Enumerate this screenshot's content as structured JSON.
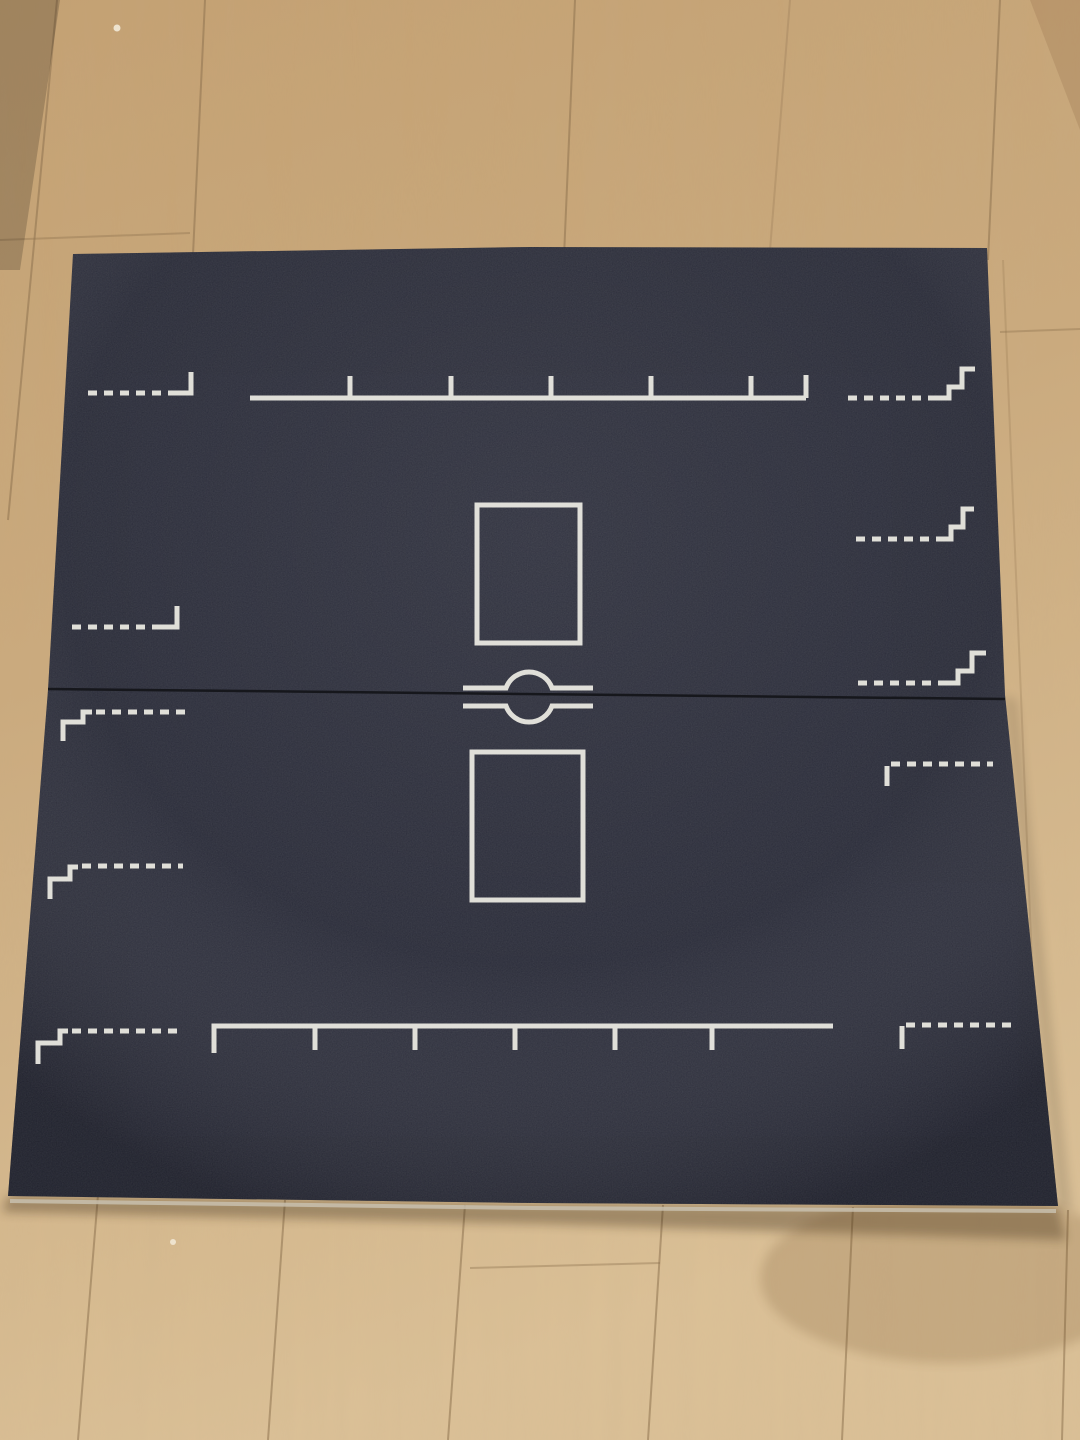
{
  "scene": {
    "description": "Top-down photograph of a black folding game pitch board lying on a light wooden plank floor",
    "board": {
      "surface_color": "#292b33",
      "marking_color": "#e7e6df",
      "fold_seam_color": "#16171c",
      "edge_highlight_color": "#c8bfae",
      "halves": 2,
      "markings": [
        {
          "name": "top-left-corner-mark",
          "type": "dashed line ending in an upward corner bracket"
        },
        {
          "name": "top-measuring-ruler",
          "type": "solid ruler line with 5 upward tick marks and an end bracket"
        },
        {
          "name": "top-right-staircase-mark",
          "type": "dashed line rising to the right in two steps"
        },
        {
          "name": "right-staircase-mark-1",
          "type": "dashed line rising to the right in two steps"
        },
        {
          "name": "right-staircase-mark-2",
          "type": "dashed line rising to the right in two steps"
        },
        {
          "name": "left-corner-mark",
          "type": "dashed line ending in an upward corner bracket"
        },
        {
          "name": "left-staircase-mark-1",
          "type": "two-step solid corner continuing as a dashed line"
        },
        {
          "name": "left-staircase-mark-2",
          "type": "two-step solid corner continuing as a dashed line"
        },
        {
          "name": "left-staircase-mark-3",
          "type": "two-step solid corner continuing as a dashed line"
        },
        {
          "name": "bottom-measuring-ruler",
          "type": "solid ruler line with 5 downward tick marks and an end bracket"
        },
        {
          "name": "bottom-right-corner-mark",
          "type": "downward corner bracket continuing as a dashed line"
        },
        {
          "name": "right-corner-mark-below-fold",
          "type": "downward corner bracket continuing as a dashed line"
        },
        {
          "name": "goal-box-top",
          "type": "rectangle outline above the fold"
        },
        {
          "name": "goal-box-bottom",
          "type": "rectangle outline below the fold"
        },
        {
          "name": "center-spot",
          "type": "circle on the fold line flanked by two horizontal lines"
        }
      ]
    },
    "floor": {
      "material": "light wooden planks",
      "base_color": "#cbaa7d",
      "highlight_color": "#dcc197",
      "warm_color": "#c39a69",
      "seam_color": "#8f7350",
      "shadow_color": "#3a2a16",
      "speck_color": "#f2ead9"
    }
  }
}
